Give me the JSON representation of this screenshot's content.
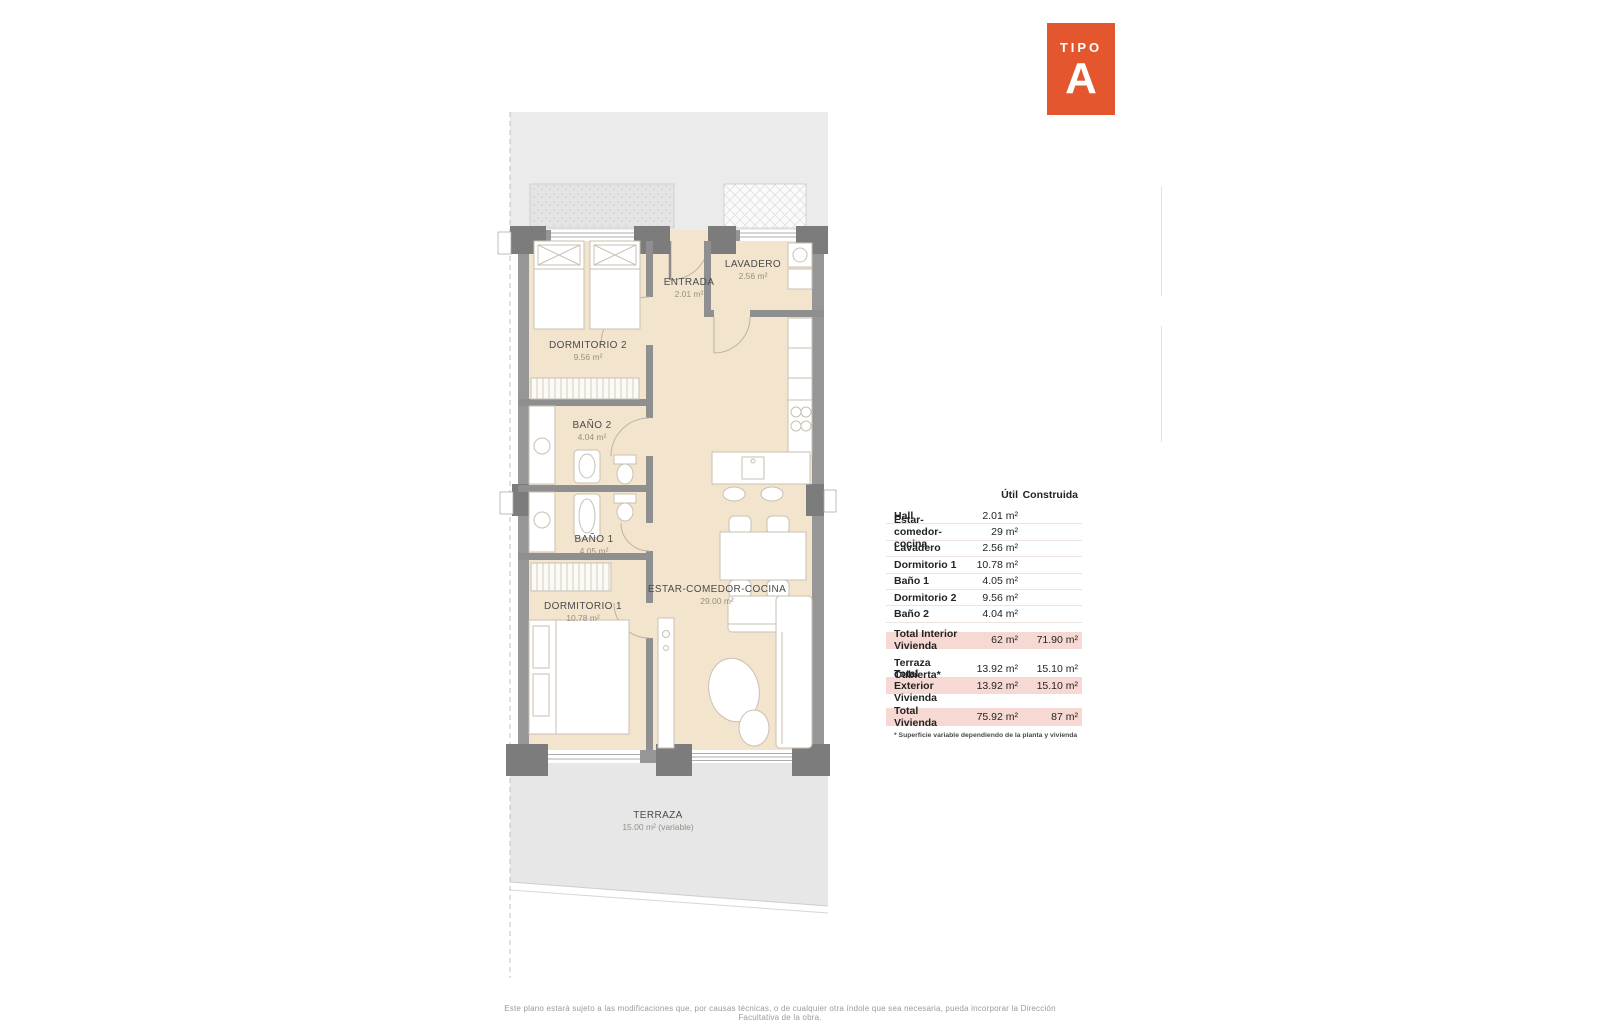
{
  "badge": {
    "label": "TIPO",
    "letter": "A"
  },
  "rooms": [
    {
      "name": "DORMITORIO 2",
      "area": "9.56 m²"
    },
    {
      "name": "ENTRADA",
      "area": "2.01 m²"
    },
    {
      "name": "LAVADERO",
      "area": "2.56 m²"
    },
    {
      "name": "BAÑO 2",
      "area": "4.04 m²"
    },
    {
      "name": "BAÑO 1",
      "area": "4.05 m²"
    },
    {
      "name": "DORMITORIO 1",
      "area": "10.78 m²"
    },
    {
      "name": "ESTAR-COMEDOR-COCINA",
      "area": "29.00 m²"
    },
    {
      "name": "TERRAZA",
      "area": "15.00 m² (variable)"
    }
  ],
  "table": {
    "headers": {
      "util": "Útil",
      "construida": "Construida"
    },
    "rows": [
      {
        "label": "Hall",
        "util": "2.01 m²",
        "construida": ""
      },
      {
        "label": "Estar-comedor-cocina",
        "util": "29 m²",
        "construida": ""
      },
      {
        "label": "Lavadero",
        "util": "2.56 m²",
        "construida": ""
      },
      {
        "label": "Dormitorio 1",
        "util": "10.78 m²",
        "construida": ""
      },
      {
        "label": "Baño 1",
        "util": "4.05 m²",
        "construida": ""
      },
      {
        "label": "Dormitorio 2",
        "util": "9.56 m²",
        "construida": ""
      },
      {
        "label": "Baño 2",
        "util": "4.04 m²",
        "construida": ""
      }
    ],
    "total_interior": {
      "label": "Total Interior Vivienda",
      "util": "62 m²",
      "construida": "71.90 m²"
    },
    "terraza_cubierta": {
      "label": "Terraza Cubierta*",
      "util": "13.92 m²",
      "construida": "15.10 m²"
    },
    "total_exterior": {
      "label": "Total Exterior Vivienda",
      "util": "13.92 m²",
      "construida": "15.10 m²"
    },
    "total_vivienda": {
      "label": "Total Vivienda",
      "util": "75.92 m²",
      "construida": "87 m²"
    },
    "footnote": "* Superficie variable dependiendo de la planta y vivienda"
  },
  "footer": {
    "disclaimer": "Este plano estará sujeto a las modificaciones que, por causas técnicas, o de cualquier otra índole que sea necesaria, pueda incorporar la Dirección Facultativa de la obra."
  },
  "colors": {
    "accent": "#E4572E",
    "highlight": "#F7D9D3",
    "floor": "#F3E4CE",
    "wall": "#969696",
    "exterior": "#EBEBEB"
  }
}
